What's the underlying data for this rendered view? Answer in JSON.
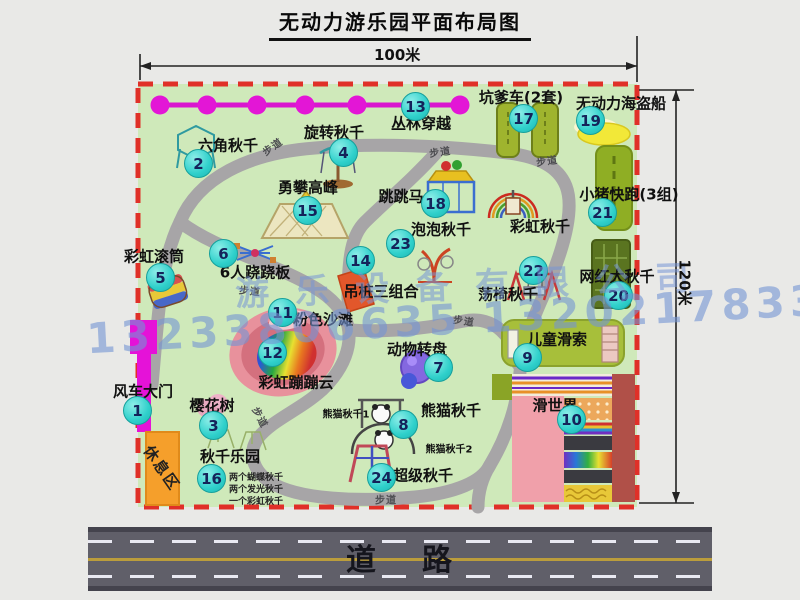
{
  "title": "无动力游乐园平面布局图",
  "dimensions": {
    "width": "100米",
    "height": "120米"
  },
  "road_label": "道路",
  "walkway_label": "步道",
  "rest_area_label": "休息区",
  "rainbow_swing_label": "彩虹秋千",
  "panda_sub_labels": {
    "one": "熊猫秋千1",
    "two": "熊猫秋千2"
  },
  "swing_notes": [
    "两个蝴蝶秋千",
    "两个发光秋千",
    "一个彩虹秋千"
  ],
  "watermark": {
    "company": "游乐设备有限公司",
    "phone": "13233806635 13202178333"
  },
  "colors": {
    "map_green": "#cfe9ba",
    "border_red": "#e03028",
    "badge_cyan": "#2fd0cb",
    "gate_magenta": "#e512d8",
    "rest_orange": "#f59f2b",
    "road_gray": "#605f69"
  },
  "attractions": [
    {
      "num": "1",
      "name": "风车大门"
    },
    {
      "num": "2",
      "name": "六角秋千"
    },
    {
      "num": "3",
      "name": "樱花树"
    },
    {
      "num": "4",
      "name": "旋转秋千"
    },
    {
      "num": "5",
      "name": "彩虹滚筒"
    },
    {
      "num": "6",
      "name": "6人跷跷板"
    },
    {
      "num": "7",
      "name": "动物转盘"
    },
    {
      "num": "8",
      "name": "熊猫秋千"
    },
    {
      "num": "9",
      "name": "儿童滑索"
    },
    {
      "num": "10",
      "name": "滑世界"
    },
    {
      "num": "11",
      "name": "粉色沙滩"
    },
    {
      "num": "12",
      "name": "彩虹蹦蹦云"
    },
    {
      "num": "13",
      "name": "丛林穿越"
    },
    {
      "num": "14",
      "name": "吊桩三组合"
    },
    {
      "num": "15",
      "name": "勇攀高峰"
    },
    {
      "num": "16",
      "name": "秋千乐园"
    },
    {
      "num": "17",
      "name": "坑爹车(2套)"
    },
    {
      "num": "18",
      "name": "跳跳马"
    },
    {
      "num": "19",
      "name": "无动力海盗船"
    },
    {
      "num": "20",
      "name": "网红大秋千"
    },
    {
      "num": "21",
      "name": "小猪快跑(3组)"
    },
    {
      "num": "22",
      "name": "荡椅秋千"
    },
    {
      "num": "23",
      "name": "泡泡秋千"
    },
    {
      "num": "24",
      "name": "超级秋千"
    }
  ]
}
